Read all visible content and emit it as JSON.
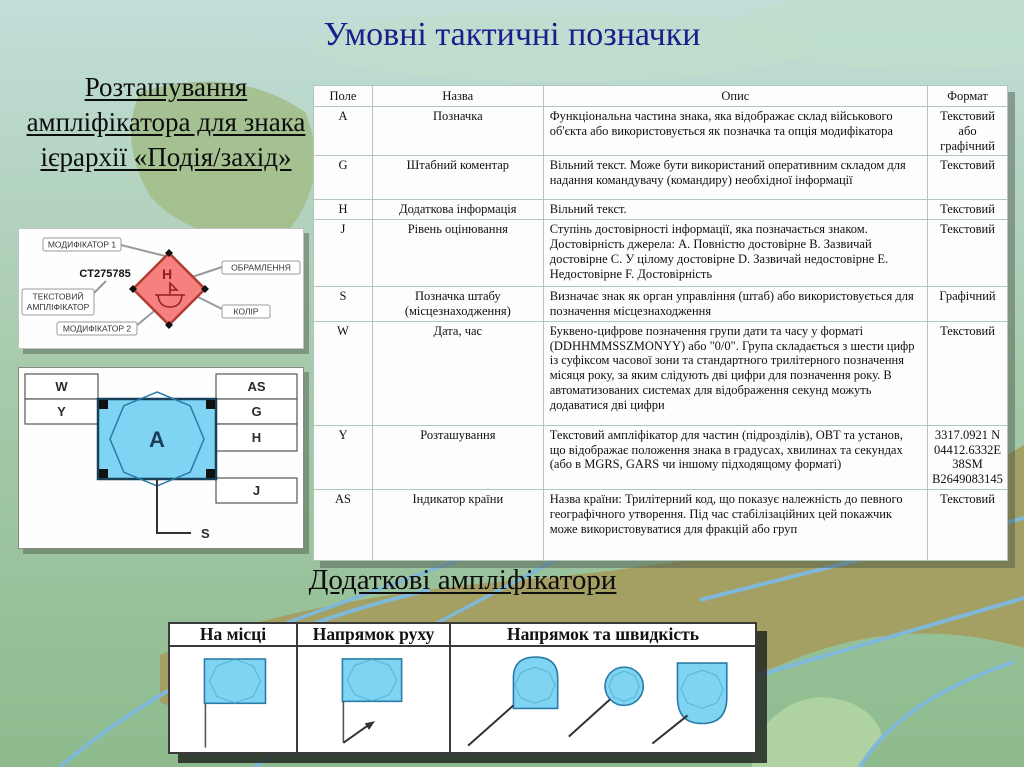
{
  "title": "Умовні тактичні позначки",
  "left_heading": "Розташування ампліфікатора для знака ієрархії «Подія/захід»",
  "diagram1": {
    "labels": {
      "modifier1": "МОДИФІКАТОР 1",
      "example_code": "CT275785",
      "text_amplifier_line1": "ТЕКСТОВИЙ",
      "text_amplifier_line2": "АМПЛІФІКАТОР",
      "modifier2": "МОДИФІКАТОР 2",
      "frame": "ОБРАМЛЕННЯ",
      "color": "КОЛІР",
      "inner_letter": "H"
    }
  },
  "diagram2": {
    "letters": {
      "w": "W",
      "y": "Y",
      "as": "AS",
      "g": "G",
      "h": "H",
      "j": "J",
      "a": "A",
      "s": "S"
    }
  },
  "main_table": {
    "headers": [
      "Поле",
      "Назва",
      "Опис",
      "Формат"
    ],
    "rows": [
      {
        "field": "A",
        "name": "Позначка",
        "desc": "Функціональна частина знака, яка відображає склад військового об'єкта або використовується як позначка та опція модифікатора",
        "format": "Текстовий або графічний"
      },
      {
        "field": "G",
        "name": "Штабний коментар",
        "desc": "Вільний текст. Може бути використаний оперативним складом для надання командувачу (командиру) необхідної інформації",
        "format": "Текстовий"
      },
      {
        "field": "H",
        "name": "Додаткова інформація",
        "desc": "Вільний текст.",
        "format": "Текстовий"
      },
      {
        "field": "J",
        "name": "Рівень оцінювання",
        "desc": "Ступінь достовірності інформації, яка позначається знаком. Достовірність джерела: A. Повністю достовірне B. Зазвичай достовірне C. У цілому достовірне D. Зазвичай недостовірне E. Недостовірне F. Достовірність",
        "format": "Текстовий"
      },
      {
        "field": "S",
        "name": "Позначка штабу (місцезнаходження)",
        "desc": "Визначає знак як орган управління (штаб) або використовується для позначення місцезнаходження",
        "format": "Графічний"
      },
      {
        "field": "W",
        "name": "Дата, час",
        "desc": "Буквено-цифрове позначення групи дати та часу у форматі (DDHHMMSSZMONYY) або \"0/0\". Група складається з шести цифр із суфіксом часової зони та стандартного трилітерного позначення місяця року, за яким слідують дві цифри для позначення року. В автоматизованих системах для відображення секунд можуть додаватися дві цифри",
        "format": "Текстовий"
      },
      {
        "field": "Y",
        "name": "Розташування",
        "desc": "Текстовий ампліфікатор для частин (підрозділів), ОВТ та установ, що відображає положення знака в градусах, хвилинах та секундах (або в MGRS, GARS чи іншому підходящому форматі)",
        "format": "3317.0921 N\n04412.6332E\n38SM\nB2649083145"
      },
      {
        "field": "AS",
        "name": "Індикатор країни",
        "desc": "Назва країни: Трилітерний код, що показує належність до певного географічного утворення. Під час стабілізаційних цей покажчик може використовуватися для фракцій або груп",
        "format": "Текстовий"
      }
    ]
  },
  "bottom_heading": "Додаткові ампліфікатори",
  "bottom_table": {
    "headers": [
      "На місці",
      "Напрямок руху",
      "Напрямок та швидкість"
    ]
  },
  "colors": {
    "title_text": "#1c1c8c",
    "table_border": "#b3c6ba",
    "symbol_blue": "#7ed4f2",
    "symbol_border": "#2a7ca8",
    "diamond_fill": "#f5807d",
    "diamond_border": "#b23b34",
    "diamond_glyph": "#8e2020",
    "bg_top": "#c1ded9",
    "bg_bottom": "#8dbb8d",
    "globe_olive": "#a49f63",
    "globe_line_blue": "#7fb8d9"
  }
}
